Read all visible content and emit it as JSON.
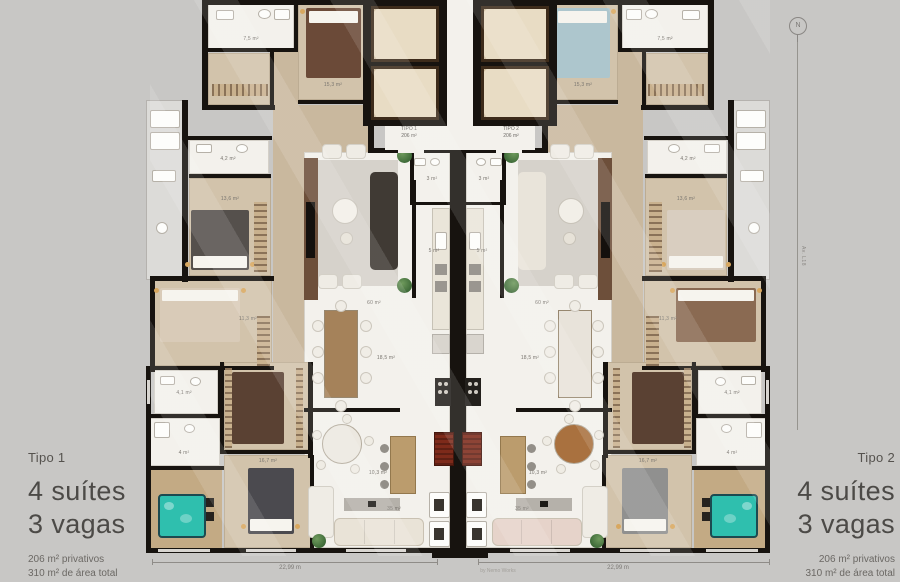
{
  "panels": {
    "left": {
      "tipo": "Tipo 1",
      "line1": "4 suítes",
      "line2": "3 vagas",
      "area1": "206 m² privativos",
      "area2": "310 m² de área total"
    },
    "right": {
      "tipo": "Tipo 2",
      "line1": "4 suítes",
      "line2": "3 vagas",
      "area1": "206 m² privativos",
      "area2": "310 m² de área total"
    }
  },
  "core": {
    "left_type": "TIPO 1",
    "left_area": "206 m²",
    "right_type": "TIPO 2",
    "right_area": "206 m²"
  },
  "rooms": {
    "suite1": "15,3 m²",
    "bath1": "7,5 m²",
    "suite2": "13,6 m²",
    "bath2": "4,2 m²",
    "suite3": "11,3 m²",
    "bath3": "4,1 m²",
    "bath4": "4 m²",
    "master": "16,7 m²",
    "living": "60 m²",
    "dining": "18,5 m²",
    "kitchen": "10,3 m²",
    "family": "35 m²",
    "lavabo": "3 m²",
    "hall": "5 m²"
  },
  "compass": {
    "label": "N"
  },
  "street": {
    "label": "Av. L18"
  },
  "dimensions": {
    "left": "22,99 m",
    "right": "22,99 m"
  },
  "credit": "by Nemo Works",
  "colors": {
    "bg": "#c8c7c5",
    "wall": "#17130f",
    "floor": "#f3f1ec",
    "wood": "#d2c3ab",
    "woodHall": "#c9b89e",
    "deck": "#c3aa84",
    "marble": "#e8dcc4",
    "marbleEdge": "#3d2b1a",
    "teal": "#2fbfae",
    "rug": "#d6d2cb",
    "grayBalcony": "#dcdbd8",
    "tvPanel": "#6d4f3a",
    "island": "#bb9c6d",
    "bbq": "#7d2a1a",
    "stove": "#23201c",
    "console": "#b5b1aa",
    "rugCloset": "#5a4133",
    "bed1Left": "#6b4a38",
    "bed1Right": "#adc6cd",
    "bed2Left": "#55504c",
    "bed2Right": "#d9cec0",
    "bed3Left": "#d9cbb8",
    "bed3Right": "#8a6a52",
    "bedMLeft": "#4b4a4f",
    "bedMRight": "#90908f",
    "sofaLeft": "#403a34",
    "sofaRight": "#e9e4da",
    "couchLeft": "#e9e3d7",
    "couchRight": "#e6d3ca",
    "diningLeft": "#a5825a",
    "diningRight": "#e8e3da",
    "breakLeft": "#ece8e0",
    "breakRight": "#a9713f"
  }
}
